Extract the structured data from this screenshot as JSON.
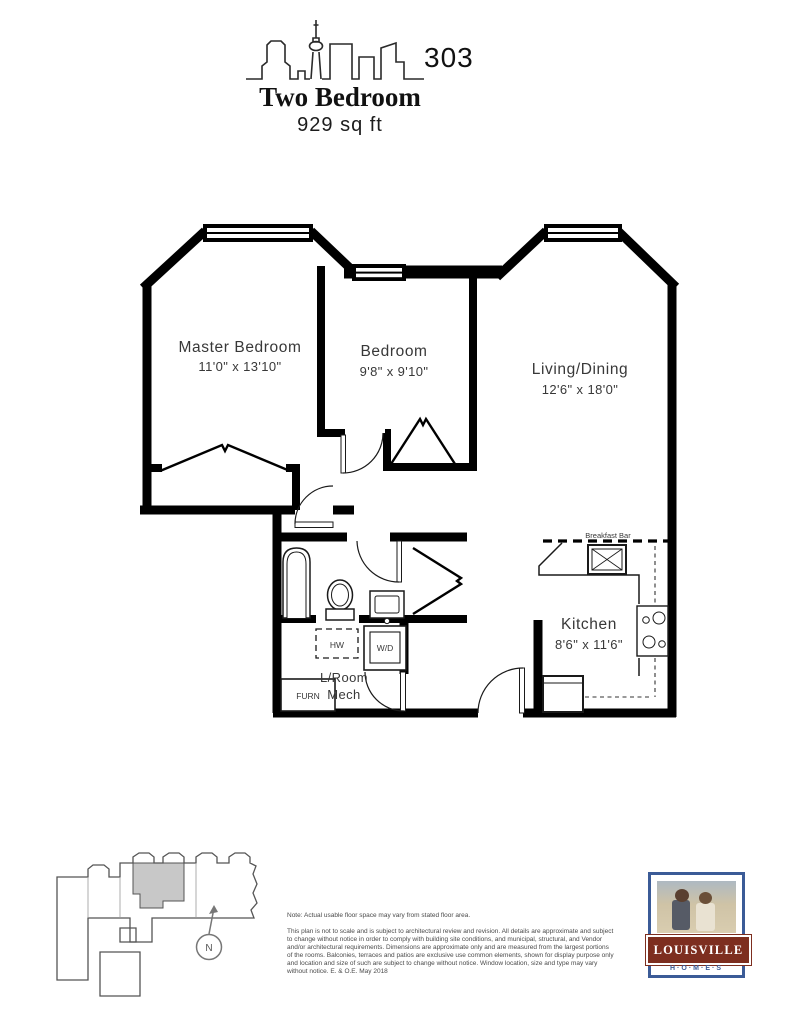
{
  "header": {
    "unit_number": "303",
    "title": "Two Bedroom",
    "area": "929 sq ft"
  },
  "rooms": {
    "master": {
      "name": "Master Bedroom",
      "dims": "11'0\" x 13'10\""
    },
    "bedroom": {
      "name": "Bedroom",
      "dims": "9'8\" x 9'10\""
    },
    "living": {
      "name": "Living/Dining",
      "dims": "12'6\" x 18'0\""
    },
    "kitchen": {
      "name": "Kitchen",
      "dims": "8'6\" x 11'6\""
    },
    "laundry": {
      "line1": "L/Room",
      "line2": "Mech"
    }
  },
  "fixtures": {
    "hot_water_tank": "HW",
    "washer_dryer": "W/D",
    "furnace": "FURN",
    "breakfast_bar": "Breakfast Bar"
  },
  "keyplan": {
    "north": "N"
  },
  "footer": {
    "note": "Note: Actual usable floor space may vary from stated floor area.",
    "disclaimer": "This plan is not to scale and is subject to architectural review and revision. All details are approximate and subject to change without notice in order to comply with building site conditions, and municipal, structural, and Vendor and/or architectural requirements. Dimensions are approximate only and are measured from the largest portions of the rooms. Balconies, terraces and patios are exclusive use common elements, shown for display purpose only and location and size of such are subject to change without notice. Window location, size and type may vary without notice. E. & O.E. May 2018"
  },
  "logo": {
    "brand": "LOUISVILLE",
    "sub": "H·O·M·E·S"
  },
  "colors": {
    "wall": "#000000",
    "unit_highlight": "#c8c8c8",
    "logo_maroon": "#7d2e1f",
    "logo_blue": "#3b5b97"
  }
}
